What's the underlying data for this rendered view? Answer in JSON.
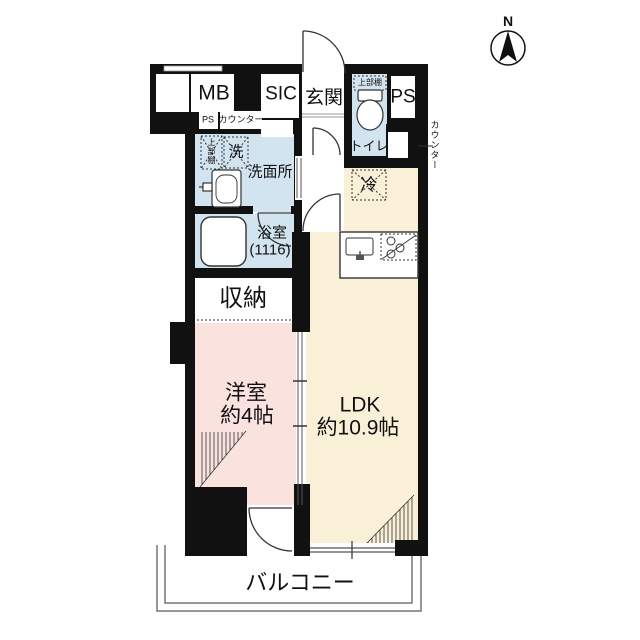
{
  "compass": {
    "north_label": "N"
  },
  "rooms": {
    "mb": {
      "label": "MB"
    },
    "sic": {
      "label": "SIC"
    },
    "genkan": {
      "label": "玄関"
    },
    "ps_top": {
      "label": "PS"
    },
    "ps_small": {
      "label": "PS"
    },
    "counter_small": {
      "label": "カウンター"
    },
    "toilet": {
      "label": "トイレ",
      "upper_shelf": "上部棚"
    },
    "counter_right": {
      "label": "カウンター"
    },
    "washroom": {
      "label": "洗面所",
      "washer": "洗",
      "upper_shelf": "上部棚"
    },
    "bathroom": {
      "label": "浴室",
      "size": "(1116)"
    },
    "storage": {
      "label": "収納"
    },
    "fridge": {
      "label": "冷"
    },
    "western_room": {
      "label": "洋室",
      "size": "約4帖"
    },
    "ldk": {
      "label": "LDK",
      "size": "約10.9帖"
    },
    "balcony": {
      "label": "バルコニー"
    }
  },
  "icons": {
    "compass": "compass-north-icon",
    "toilet": "toilet-icon",
    "bathtub": "bathtub-icon",
    "washbasin": "washbasin-icon",
    "kitchen_sink": "kitchen-sink-icon",
    "stove": "stove-icon"
  },
  "colors": {
    "wall": "#111111",
    "wet_area": "#d3e4f1",
    "ldk_floor": "#faf0d8",
    "western_room_floor": "#fae3df",
    "outline_gray": "#777777"
  }
}
